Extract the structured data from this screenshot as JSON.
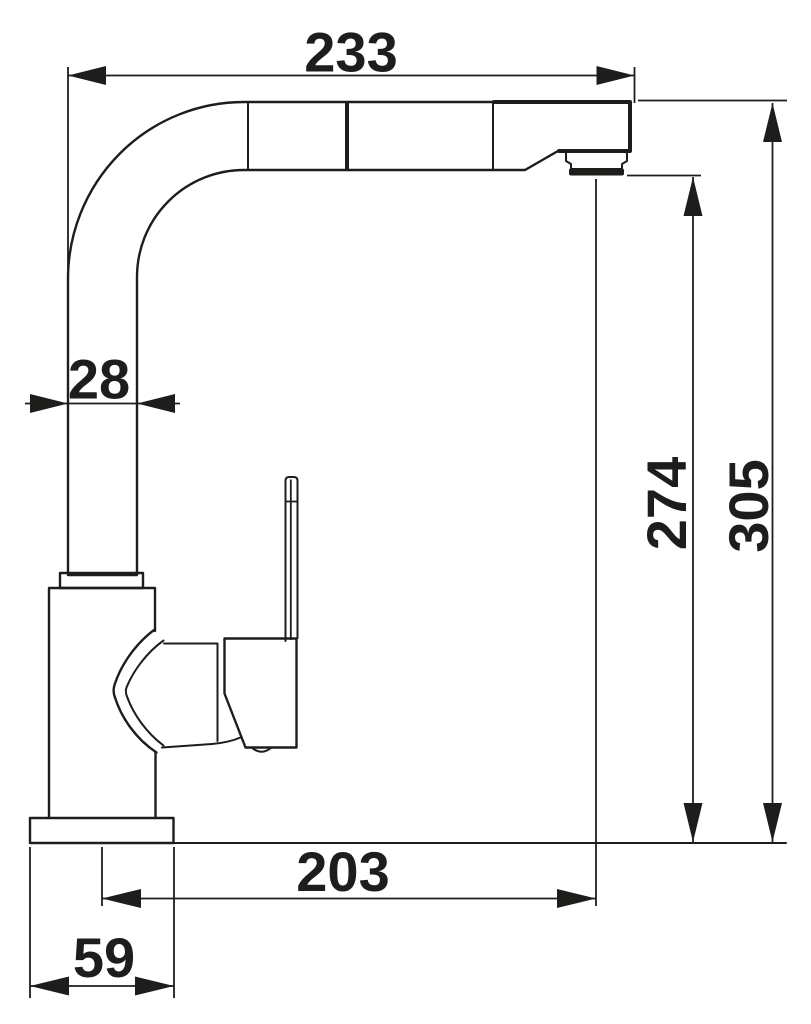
{
  "colors": {
    "ink": "#1d1d1b",
    "background": "#ffffff"
  },
  "drawing": {
    "dimensions": {
      "spout_reach_top": "233",
      "spout_tube_width": "28",
      "outlet_height": "274",
      "overall_height": "305",
      "outlet_reach": "203",
      "base_width": "59"
    }
  }
}
